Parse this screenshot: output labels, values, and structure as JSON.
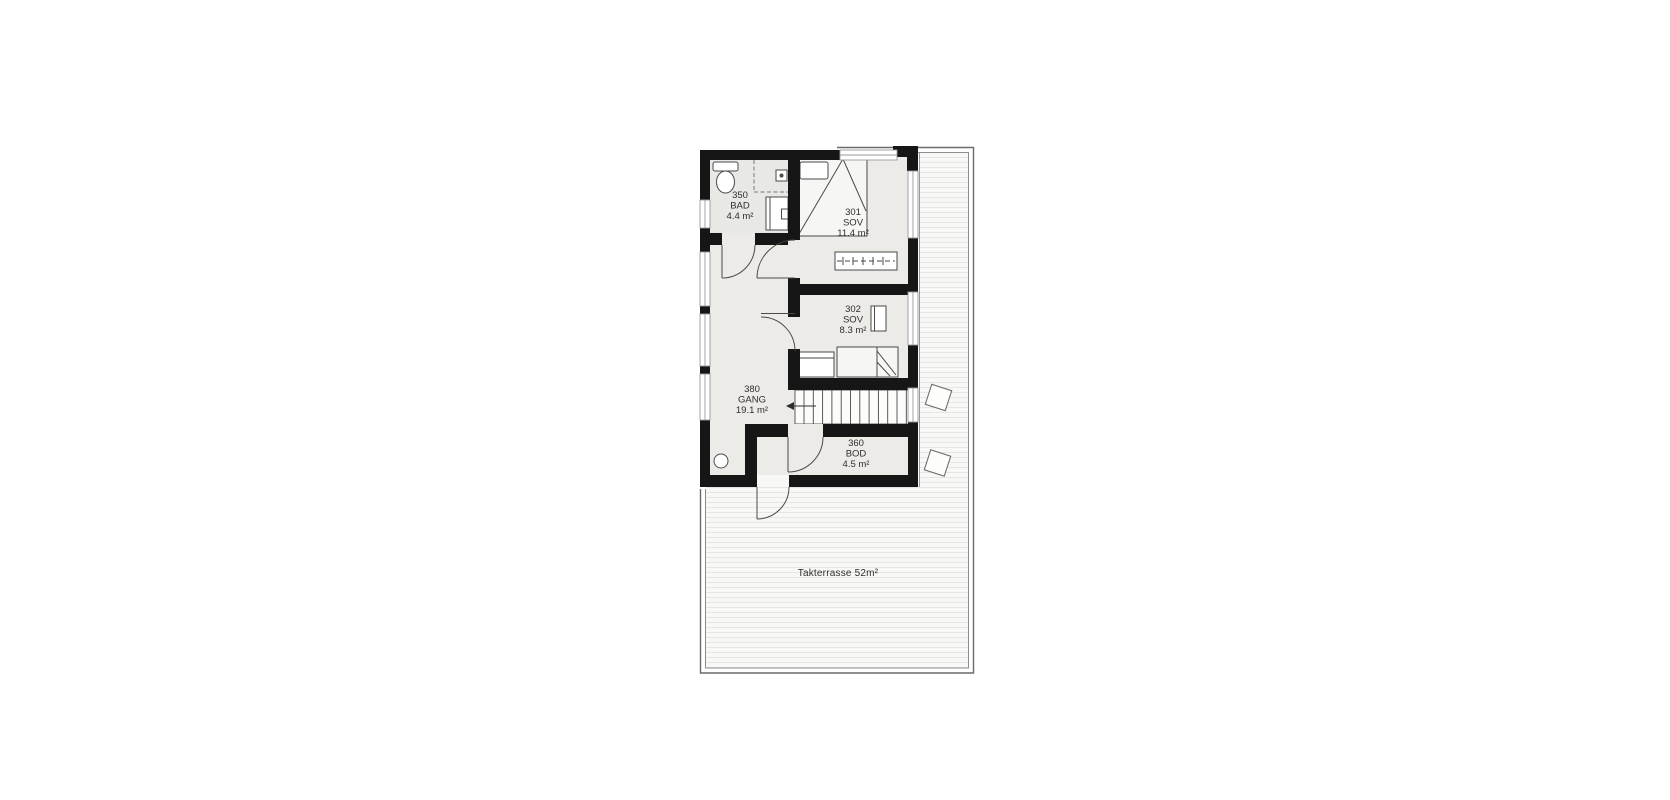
{
  "floor_plan": {
    "rooms": [
      {
        "number": "350",
        "name": "BAD",
        "area": "4.4 m²"
      },
      {
        "number": "301",
        "name": "SOV",
        "area": "11.4 m²"
      },
      {
        "number": "302",
        "name": "SOV",
        "area": "8.3 m²"
      },
      {
        "number": "380",
        "name": "GANG",
        "area": "19.1 m²"
      },
      {
        "number": "360",
        "name": "BOD",
        "area": "4.5 m²"
      }
    ],
    "terrace": {
      "label": "Takterrasse 52m²"
    },
    "colors": {
      "wall": "#161616",
      "floor": "#ecebe8",
      "bath_floor": "#e8e8e4",
      "outline": "#4a4a4a",
      "deck_stripe": "#e6e6e4",
      "deck_background": "#f8f8f7"
    }
  }
}
